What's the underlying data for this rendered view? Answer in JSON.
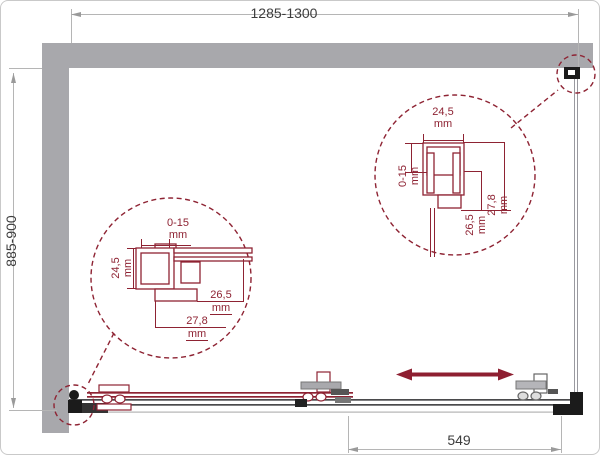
{
  "drawing_title": "shower-enclosure-technical-drawing",
  "labels": {
    "width": "1285-1300",
    "depth": "885-900",
    "door": "549"
  },
  "callout_left": {
    "adjust_value": "0-15",
    "adjust_unit": "mm",
    "width_value": "24,5",
    "width_unit": "mm",
    "inner_value": "26,5",
    "inner_unit": "mm",
    "outer_value": "27,8",
    "outer_unit": "mm"
  },
  "callout_right": {
    "width_value": "24,5",
    "width_unit": "mm",
    "adjust_value": "0-15",
    "adjust_unit": "mm",
    "inner_value": "26,5",
    "inner_unit": "mm",
    "outer_value": "27,8",
    "outer_unit": "mm"
  },
  "colors": {
    "wall": "#a8a8ac",
    "accent": "#8e2333",
    "arrow": "#8e1f31",
    "dim_line": "#b5b5b5",
    "dim_arrow": "#9a9a9a",
    "dim_text": "#3d3d3d",
    "rail_dark": "#4a4a4c",
    "fitting_black": "#1b1b1b",
    "glass_line": "#9a9aa0"
  }
}
